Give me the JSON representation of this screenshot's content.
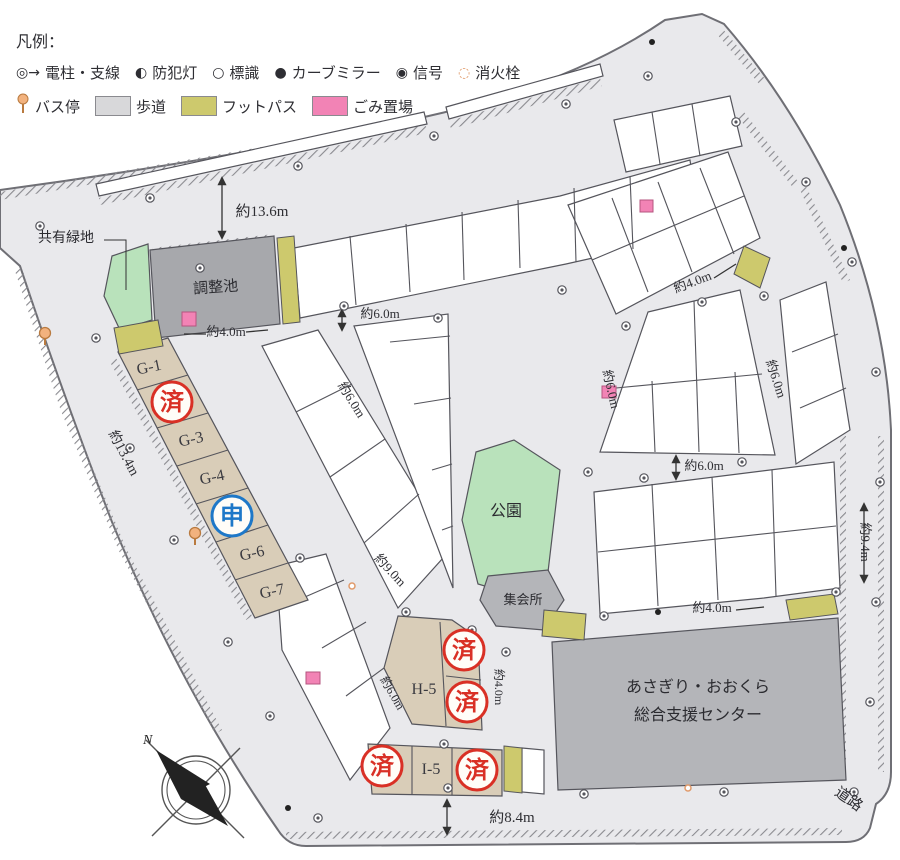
{
  "legend": {
    "title": "凡例：",
    "row1": [
      {
        "name": "utility-pole-icon",
        "glyph": "◎→",
        "label": "電柱・支線"
      },
      {
        "name": "security-light-icon",
        "glyph": "◐",
        "label": "防犯灯"
      },
      {
        "name": "sign-icon",
        "glyph": "○",
        "label": "標識"
      },
      {
        "name": "curve-mirror-icon",
        "glyph": "●",
        "label": "カーブミラー"
      },
      {
        "name": "signal-icon",
        "glyph": "◉",
        "label": "信号"
      },
      {
        "name": "fire-hydrant-icon",
        "glyph": "◌",
        "label": "消火栓"
      }
    ],
    "row2": [
      {
        "name": "bus-stop-icon",
        "type": "bus",
        "label": "バス停"
      },
      {
        "name": "sidewalk-swatch",
        "type": "swatch",
        "color": "#d8d8da",
        "label": "歩道"
      },
      {
        "name": "footpath-swatch",
        "type": "swatch",
        "color": "#cdc96d",
        "label": "フットパス"
      },
      {
        "name": "garbage-swatch",
        "type": "swatch",
        "color": "#f283b5",
        "label": "ごみ置場"
      }
    ]
  },
  "map": {
    "colors": {
      "road": "#e9e9ec",
      "road_edge": "#6f6f75",
      "lot_line": "#55555c",
      "tan": "#d9cdb8",
      "pond_gray": "#a7a8ac",
      "building_gray": "#b4b5b9",
      "green": "#b9e2bb",
      "yellow": "#cdc96d",
      "pink": "#f283b5",
      "stamp_red": "#d93025",
      "stamp_blue": "#1e78c8",
      "orange": "#f2b27e"
    },
    "area_labels": [
      {
        "name": "shared-green-label",
        "t": "共有緑地",
        "x": 66,
        "y": 242,
        "r": 0,
        "s": 14
      },
      {
        "name": "retention-pond-label",
        "t": "調整池",
        "x": 216,
        "y": 292,
        "r": -4,
        "s": 15
      },
      {
        "name": "park-label",
        "t": "公園",
        "x": 506,
        "y": 516,
        "r": 0,
        "s": 16
      },
      {
        "name": "meeting-hall-label",
        "t": "集会所",
        "x": 523,
        "y": 604,
        "r": 0,
        "s": 13
      },
      {
        "name": "support-center-label-1",
        "t": "あさぎり・おおくら",
        "x": 698,
        "y": 692,
        "r": 0,
        "s": 16
      },
      {
        "name": "support-center-label-2",
        "t": "総合支援センター",
        "x": 698,
        "y": 720,
        "r": 0,
        "s": 16
      },
      {
        "name": "road-label",
        "t": "道路",
        "x": 846,
        "y": 803,
        "r": 35,
        "s": 15
      }
    ],
    "lot_labels": [
      {
        "t": "G-1",
        "x": 150,
        "y": 372,
        "r": -12
      },
      {
        "t": "G-3",
        "x": 192,
        "y": 444,
        "r": -12
      },
      {
        "t": "G-4",
        "x": 213,
        "y": 482,
        "r": -12
      },
      {
        "t": "G-6",
        "x": 253,
        "y": 558,
        "r": -12
      },
      {
        "t": "G-7",
        "x": 273,
        "y": 596,
        "r": -12
      },
      {
        "t": "H-5",
        "x": 424,
        "y": 694,
        "r": 0
      },
      {
        "t": "I-5",
        "x": 431,
        "y": 774,
        "r": 0
      }
    ],
    "measurements": [
      {
        "t": "約13.6m",
        "x": 262,
        "y": 216,
        "r": 0,
        "s": 15
      },
      {
        "t": "約4.0m",
        "x": 226,
        "y": 336,
        "r": 0,
        "s": 13
      },
      {
        "t": "約6.0m",
        "x": 380,
        "y": 318,
        "r": 0,
        "s": 13
      },
      {
        "t": "約6.0m",
        "x": 348,
        "y": 402,
        "r": 58,
        "s": 13
      },
      {
        "t": "約13.4m",
        "x": 120,
        "y": 455,
        "r": 62,
        "s": 14
      },
      {
        "t": "約6.0m",
        "x": 607,
        "y": 390,
        "r": 77,
        "s": 13
      },
      {
        "t": "約4.0m",
        "x": 694,
        "y": 286,
        "r": -21,
        "s": 13
      },
      {
        "t": "約6.0m",
        "x": 772,
        "y": 380,
        "r": 72,
        "s": 13
      },
      {
        "t": "約6.0m",
        "x": 704,
        "y": 470,
        "r": 0,
        "s": 13
      },
      {
        "t": "約9.4m",
        "x": 861,
        "y": 542,
        "r": 90,
        "s": 13
      },
      {
        "t": "約9.0m",
        "x": 387,
        "y": 573,
        "r": 47,
        "s": 13
      },
      {
        "t": "約6.0m",
        "x": 389,
        "y": 695,
        "r": 60,
        "s": 12
      },
      {
        "t": "約4.0m",
        "x": 495,
        "y": 687,
        "r": 90,
        "s": 12
      },
      {
        "t": "約4.0m",
        "x": 712,
        "y": 612,
        "r": 0,
        "s": 13
      },
      {
        "t": "約8.4m",
        "x": 512,
        "y": 822,
        "r": 0,
        "s": 15
      }
    ],
    "stamps": [
      {
        "t": "済",
        "x": 172,
        "y": 402,
        "c": "#d93025"
      },
      {
        "t": "申",
        "x": 232,
        "y": 516,
        "c": "#1e78c8"
      },
      {
        "t": "済",
        "x": 464,
        "y": 650,
        "c": "#d93025"
      },
      {
        "t": "済",
        "x": 467,
        "y": 702,
        "c": "#d93025"
      },
      {
        "t": "済",
        "x": 382,
        "y": 766,
        "c": "#d93025"
      },
      {
        "t": "済",
        "x": 477,
        "y": 770,
        "c": "#d93025"
      }
    ],
    "symbols": {
      "utility_poles": [
        [
          40,
          226
        ],
        [
          150,
          198
        ],
        [
          298,
          166
        ],
        [
          434,
          136
        ],
        [
          566,
          104
        ],
        [
          648,
          76
        ],
        [
          736,
          122
        ],
        [
          806,
          182
        ],
        [
          852,
          262
        ],
        [
          876,
          372
        ],
        [
          880,
          482
        ],
        [
          876,
          602
        ],
        [
          870,
          702
        ],
        [
          854,
          792
        ],
        [
          724,
          792
        ],
        [
          584,
          794
        ],
        [
          448,
          788
        ],
        [
          318,
          818
        ],
        [
          200,
          268
        ],
        [
          96,
          338
        ],
        [
          130,
          448
        ],
        [
          174,
          540
        ],
        [
          228,
          642
        ],
        [
          270,
          716
        ],
        [
          344,
          306
        ],
        [
          438,
          318
        ],
        [
          562,
          290
        ],
        [
          626,
          326
        ],
        [
          702,
          302
        ],
        [
          764,
          296
        ],
        [
          588,
          472
        ],
        [
          644,
          478
        ],
        [
          742,
          462
        ],
        [
          836,
          592
        ],
        [
          604,
          616
        ],
        [
          472,
          630
        ],
        [
          300,
          558
        ],
        [
          406,
          612
        ],
        [
          506,
          652
        ],
        [
          444,
          744
        ]
      ],
      "curve_mirrors": [
        [
          652,
          42
        ],
        [
          844,
          248
        ],
        [
          288,
          808
        ],
        [
          658,
          612
        ]
      ],
      "bus_stops": [
        [
          195,
          533
        ],
        [
          45,
          333
        ]
      ],
      "fire_hydrants": [
        [
          352,
          586
        ],
        [
          688,
          788
        ]
      ]
    },
    "compass_label": "N"
  }
}
